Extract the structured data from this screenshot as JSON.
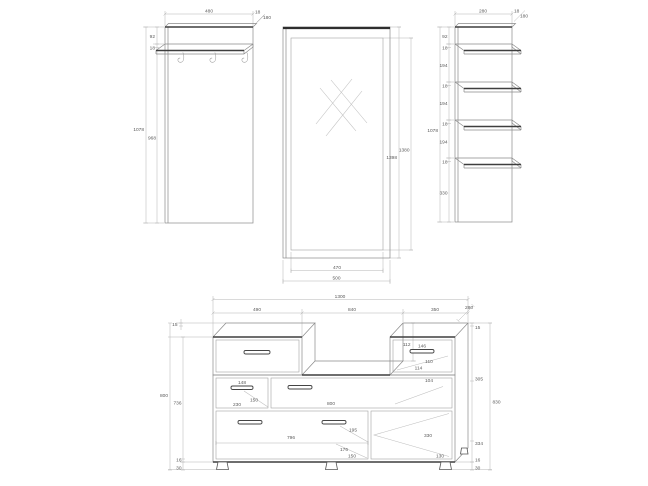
{
  "pieces": {
    "coat_rack": {
      "width": "480",
      "board": "18",
      "depth": "180",
      "top_gap": "92",
      "shelf_board": "18",
      "height": "1078",
      "lower": "968"
    },
    "mirror": {
      "height": "1398",
      "glass_height": "1380",
      "glass_width": "470",
      "width": "500"
    },
    "shelf_unit": {
      "width": "280",
      "board": "18",
      "depth": "180",
      "height": "1078",
      "col": [
        "92",
        "18",
        "194",
        "18",
        "194",
        "18",
        "194",
        "18",
        "330"
      ]
    },
    "cabinet": {
      "width_total": "1300",
      "width_left": "490",
      "width_right": "840",
      "width_top_box": "350",
      "depth": "280",
      "board_top": "15",
      "riser_height": "112",
      "top_drawer_handle": "146",
      "top_drawer_a": "110",
      "top_drawer_b": "114",
      "top_drawer_c": "104",
      "small_drawer_handle": "148",
      "small_drawer_a": "150",
      "small_drawer_b": "230",
      "wide_drawer_width": "800",
      "big_drawer_width": "796",
      "big_drawer_a": "195",
      "big_drawer_b": "176",
      "big_drawer_c": "150",
      "door_width": "330",
      "door_b": "130",
      "right_col": [
        "15",
        "305",
        "334",
        "16",
        "30"
      ],
      "height_right": "830",
      "height_left": "800",
      "height_inner": "736",
      "base_board": "16",
      "leg_height": "30"
    }
  }
}
